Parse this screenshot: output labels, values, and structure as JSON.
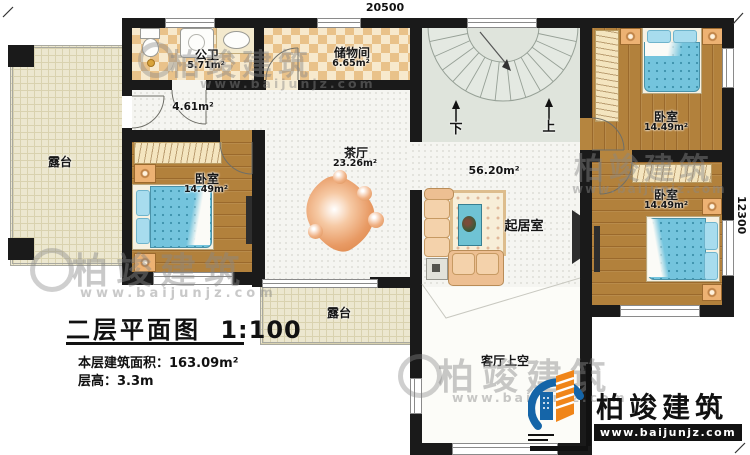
{
  "dimensions": {
    "top": "20500",
    "right": "12300"
  },
  "rooms": {
    "terrace_left": {
      "name": "露台"
    },
    "bath": {
      "name": "公卫",
      "area": "5.71m²"
    },
    "storage": {
      "name": "储物间",
      "area": "6.65m²"
    },
    "hallway": {
      "area": "4.61m²"
    },
    "tea_room": {
      "name": "茶厅",
      "area": "23.26m²"
    },
    "bedroom_left": {
      "name": "卧室",
      "area": "14.49m²"
    },
    "bedroom_top_right": {
      "name": "卧室",
      "area": "14.49m²"
    },
    "bedroom_mid_right": {
      "name": "卧室",
      "area": "14.49m²"
    },
    "living_room": {
      "name": "起居室",
      "area": "56.20m²"
    },
    "terrace_bottom": {
      "name": "露台"
    },
    "void_over_living": {
      "name": "客厅上空"
    }
  },
  "stairs": {
    "down": "下",
    "up": "上"
  },
  "title_block": {
    "title": "二层平面图",
    "scale": "1:100",
    "area_label": "本层建筑面积：",
    "area_value": "163.09m²",
    "height_label": "层高：",
    "height_value": "3.3m"
  },
  "brand": {
    "name": "柏竣建筑",
    "url": "www.baijunjz.com"
  },
  "colors": {
    "wall": "#1a1a1a",
    "brand_blue": "#1565a8",
    "brand_orange": "#f08519"
  }
}
